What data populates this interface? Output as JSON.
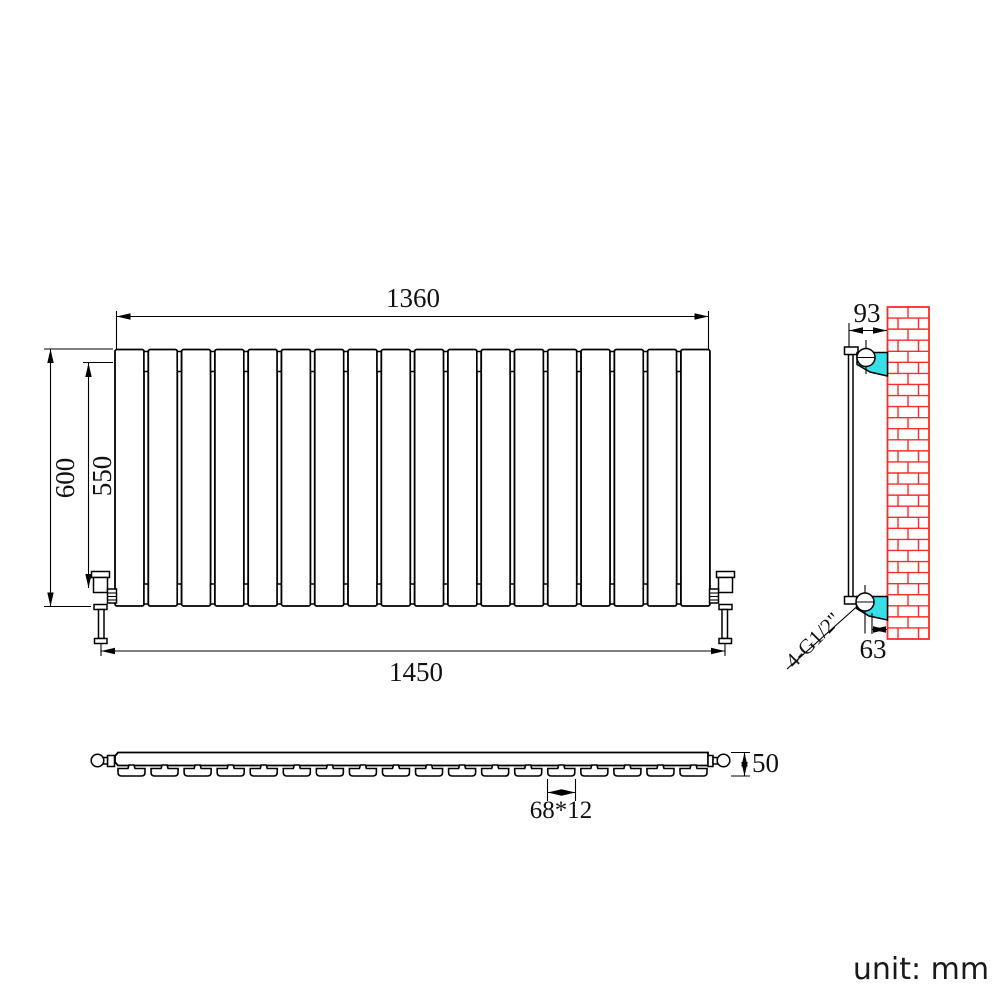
{
  "meta": {
    "unit_label": "unit: mm"
  },
  "colors": {
    "line": "#000000",
    "brick_red": "#ff2b2b",
    "bracket_cyan": "#38dfe8",
    "background": "#ffffff"
  },
  "front_view": {
    "panel_count": 18,
    "dimensions": {
      "width_top": "1360",
      "width_bottom": "1450",
      "height_outer": "600",
      "height_inner": "550"
    }
  },
  "side_view": {
    "dimensions": {
      "wall_offset_top": "93",
      "wall_offset_bottom": "63"
    },
    "connection_label": "4-G1/2\""
  },
  "bottom_view": {
    "tab_count": 18,
    "dimensions": {
      "depth": "50",
      "panel_section": "68*12"
    }
  }
}
